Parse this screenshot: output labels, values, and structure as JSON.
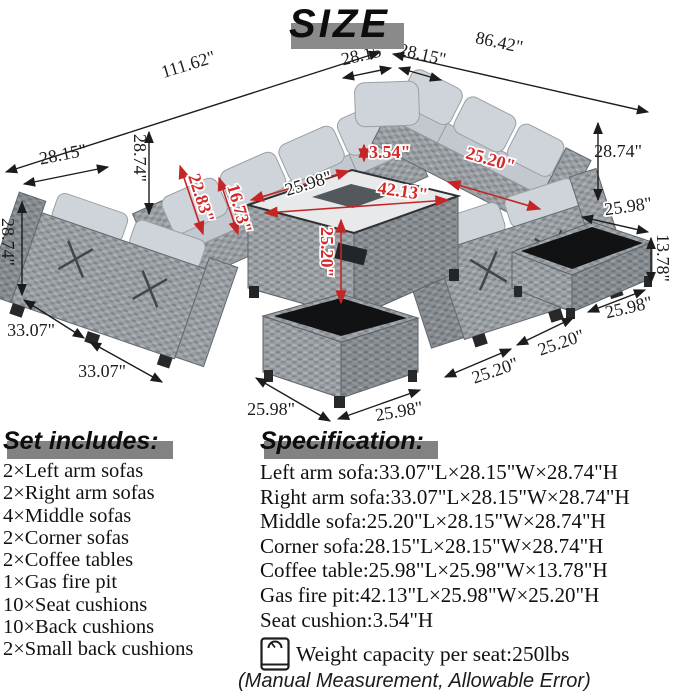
{
  "title": "SIZE",
  "diagram": {
    "dims": {
      "sectional_left_length": "111.62\"",
      "seat_width_left": "28.15\"",
      "seat_width_right": "28.15\"",
      "sectional_right_length": "86.42\"",
      "sofa_depth": "28.15\"",
      "sofa_height_back_left": "28.74\"",
      "sofa_height_front_left": "28.74\"",
      "sofa_height_right": "28.74\"",
      "arm_height": "22.83\"",
      "arm_inner_height": "16.73\"",
      "seat_cushion_height": "3.54\"",
      "firepit_width": "25.98\"",
      "firepit_length": "42.13\"",
      "firepit_height": "25.20\"",
      "right_seat_width": "25.20\"",
      "coffee_table_top_side": "25.98\"",
      "coffee_table_height": "13.78\"",
      "coffee_table_bottom_side": "25.98\"",
      "left_sofa_length_upper": "33.07\"",
      "left_sofa_length_lower": "33.07\"",
      "ottoman_left_side": "25.98\"",
      "ottoman_front_side": "25.98\"",
      "middle_seat_front": "25.20\"",
      "middle_seat_right": "25.20\""
    }
  },
  "set_includes": {
    "heading": "Set includes:",
    "items": [
      "2×Left arm sofas",
      "2×Right arm sofas",
      "4×Middle sofas",
      "2×Corner sofas",
      "2×Coffee tables",
      "1×Gas fire pit",
      "10×Seat cushions",
      "10×Back cushions",
      "2×Small back cushions"
    ]
  },
  "specification": {
    "heading": "Specification:",
    "items": [
      "Left arm sofa:33.07\"L×28.15\"W×28.74\"H",
      "Right arm sofa:33.07\"L×28.15\"W×28.74\"H",
      "Middle sofa:25.20\"L×28.15\"W×28.74\"H",
      "Corner sofa:28.15\"L×28.15\"W×28.74\"H",
      "Coffee table:25.98\"L×25.98\"W×13.78\"H",
      "Gas fire pit:42.13\"L×25.98\"W×25.20\"H",
      "Seat cushion:3.54\"H"
    ],
    "weight_capacity": "Weight capacity per seat:250lbs"
  },
  "footnote": "(Manual Measurement, Allowable Error)",
  "colors": {
    "dimension_black": "#1c1c1c",
    "dimension_red": "#d42a2a",
    "wicker_gray": "#999ea3",
    "cushion_gray": "#ced4d9",
    "heading_bar_gray": "#828282"
  }
}
